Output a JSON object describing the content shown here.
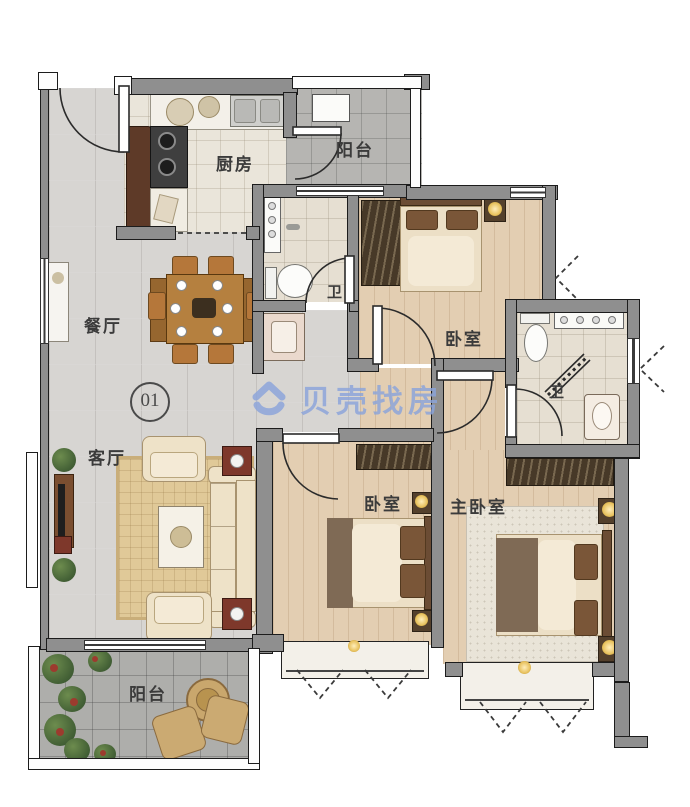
{
  "canvas": {
    "width": 690,
    "height": 807
  },
  "watermark": {
    "text": "贝壳找房",
    "color": "#8BA4DB"
  },
  "unit": {
    "number": "01"
  },
  "rooms": {
    "kitchen": {
      "label": "厨房"
    },
    "balcony_top": {
      "label": "阳台"
    },
    "dining": {
      "label": "餐厅"
    },
    "living": {
      "label": "客厅"
    },
    "balcony_bottom": {
      "label": "阳台"
    },
    "bedroom_top": {
      "label": "卧室"
    },
    "bedroom_middle": {
      "label": "卧室"
    },
    "master_bedroom": {
      "label": "主卧室"
    },
    "bathroom_main": {
      "label": "卫"
    },
    "bathroom_master": {
      "label": "卫"
    }
  },
  "palette": {
    "wall": "#8F8F8F",
    "wood_floor": "#E3CEB2",
    "tile_floor": "#D7D5D2",
    "kitchen_floor": "#EAE5DA",
    "bath_floor": "#E6DFD2",
    "balcony_floor": "#B4B3B0",
    "furniture_cream": "#ECDFC6",
    "furniture_dark_wood": "#6B4C34",
    "watermark_blue": "#8BA4DB"
  }
}
